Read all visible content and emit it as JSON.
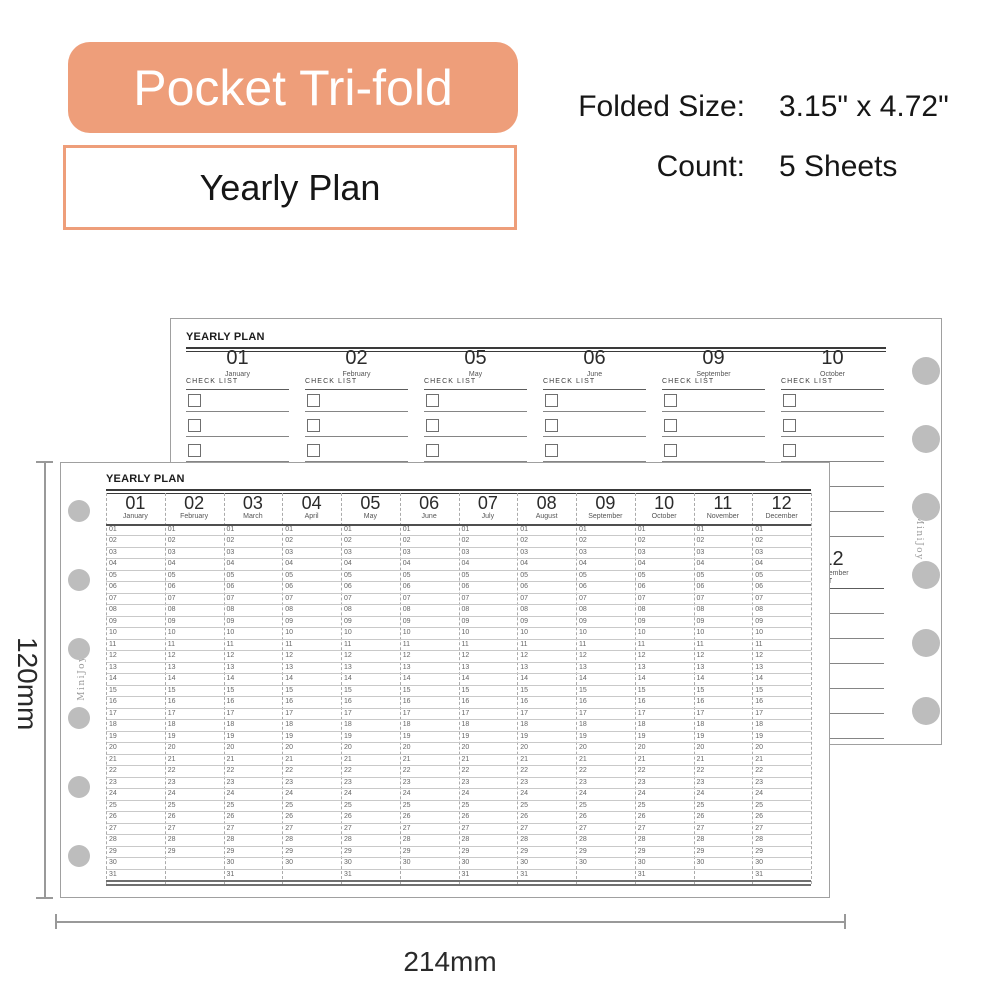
{
  "colors": {
    "accent": "#EE9E7A",
    "hole": "#BDBDBD"
  },
  "header": {
    "badge": "Pocket Tri-fold",
    "subtitle": "Yearly Plan",
    "specs": [
      {
        "label": "Folded Size:",
        "value": "3.15\" x 4.72\""
      },
      {
        "label": "Count:",
        "value": "5 Sheets"
      }
    ]
  },
  "dimensions": {
    "height": "120mm",
    "width": "214mm"
  },
  "brand": "MiniJoy",
  "back_sheet": {
    "title": "YEARLY PLAN",
    "checklist_label": "CHECK LIST",
    "checklist_rows": 6,
    "top_sections": [
      {
        "num": "01",
        "month": "January"
      },
      {
        "num": "02",
        "month": "February"
      },
      {
        "num": "05",
        "month": "May"
      },
      {
        "num": "06",
        "month": "June"
      },
      {
        "num": "09",
        "month": "September"
      },
      {
        "num": "10",
        "month": "October"
      }
    ],
    "bottom_sections": [
      {
        "num": "03",
        "month": "March"
      },
      {
        "num": "04",
        "month": "April"
      },
      {
        "num": "07",
        "month": "July"
      },
      {
        "num": "08",
        "month": "August"
      },
      {
        "num": "11",
        "month": "November"
      },
      {
        "num": "12",
        "month": "December"
      }
    ]
  },
  "front_sheet": {
    "title": "YEARLY PLAN",
    "day_rows": 31,
    "months": [
      {
        "num": "01",
        "month": "January",
        "days": 31
      },
      {
        "num": "02",
        "month": "February",
        "days": 29
      },
      {
        "num": "03",
        "month": "March",
        "days": 31
      },
      {
        "num": "04",
        "month": "April",
        "days": 30
      },
      {
        "num": "05",
        "month": "May",
        "days": 31
      },
      {
        "num": "06",
        "month": "June",
        "days": 30
      },
      {
        "num": "07",
        "month": "July",
        "days": 31
      },
      {
        "num": "08",
        "month": "August",
        "days": 31
      },
      {
        "num": "09",
        "month": "September",
        "days": 30
      },
      {
        "num": "10",
        "month": "October",
        "days": 31
      },
      {
        "num": "11",
        "month": "November",
        "days": 30
      },
      {
        "num": "12",
        "month": "December",
        "days": 31
      }
    ]
  }
}
